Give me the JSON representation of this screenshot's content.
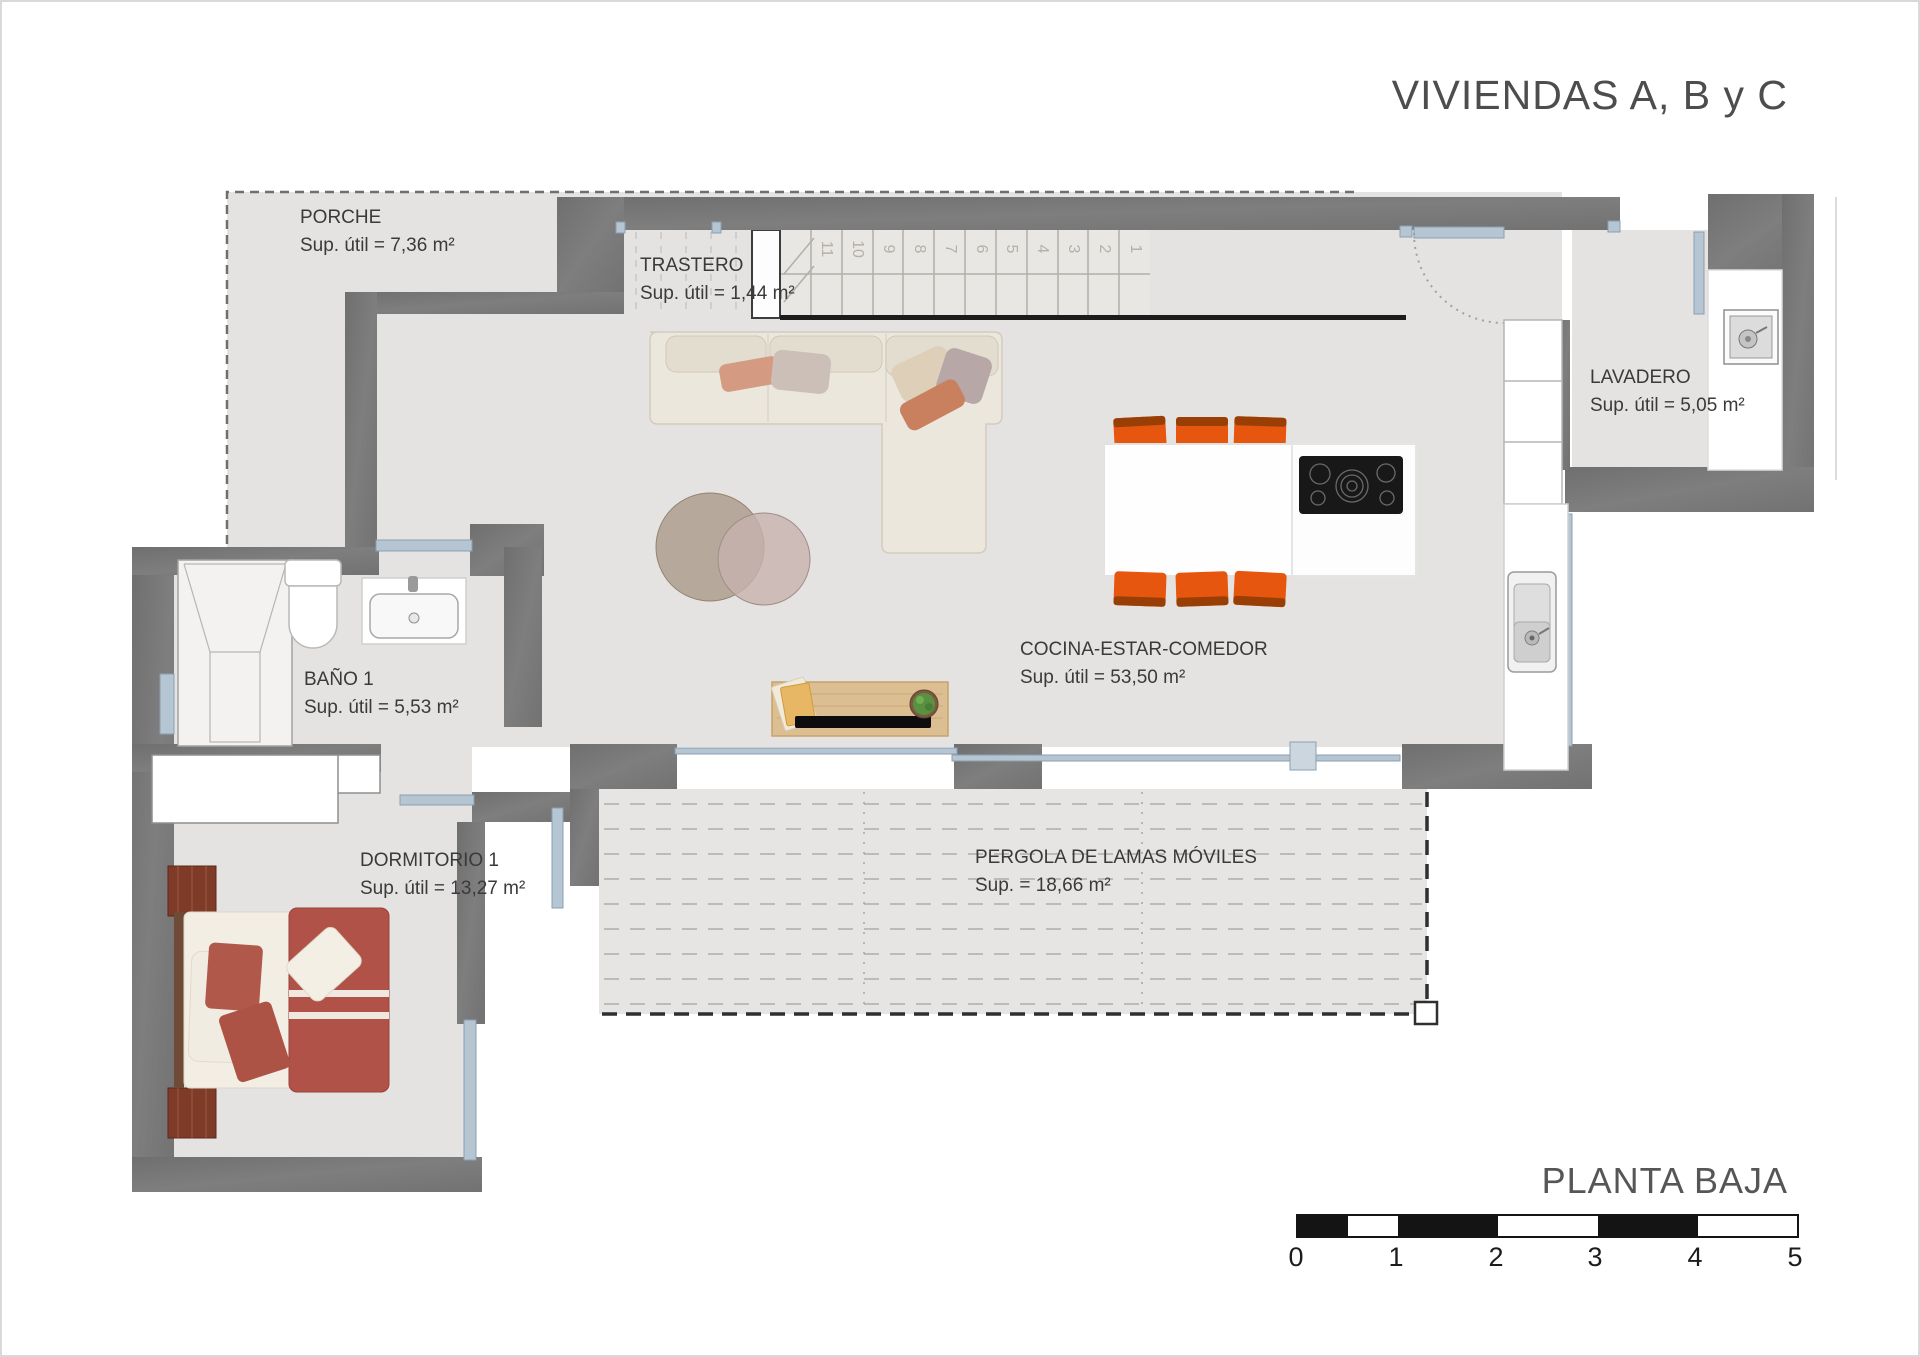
{
  "title": "VIVIENDAS A, B y C",
  "plan_name": "PLANTA BAJA",
  "rooms": [
    {
      "id": "porche",
      "name": "PORCHE",
      "area": "Sup. útil = 7,36 m²"
    },
    {
      "id": "trastero",
      "name": "TRASTERO",
      "area": "Sup. útil = 1,44 m²"
    },
    {
      "id": "lavadero",
      "name": "LAVADERO",
      "area": "Sup. útil = 5,05 m²"
    },
    {
      "id": "bano1",
      "name": "BAÑO 1",
      "area": "Sup. útil = 5,53 m²"
    },
    {
      "id": "dormitorio1",
      "name": "DORMITORIO 1",
      "area": "Sup. útil = 13,27 m²"
    },
    {
      "id": "cocina",
      "name": "COCINA-ESTAR-COMEDOR",
      "area": "Sup. útil = 53,50 m²"
    },
    {
      "id": "pergola",
      "name": "PERGOLA DE LAMAS MÓVILES",
      "area": "Sup. = 18,66 m²"
    }
  ],
  "stairs": {
    "steps": [
      "1",
      "2",
      "3",
      "4",
      "5",
      "6",
      "7",
      "8",
      "9",
      "10",
      "11"
    ]
  },
  "scale_bar": {
    "labels": [
      "0",
      "1",
      "2",
      "3",
      "4",
      "5"
    ]
  },
  "colors": {
    "wall": "#757575",
    "floor": "#e4e3e1",
    "pergola_floor": "#e7e5e3",
    "window_blue": "#b6c5d2",
    "chair_orange": "#e6560f",
    "bed_red": "#b05247",
    "wood": "#dcbe93",
    "text": "#3a3a3a"
  }
}
